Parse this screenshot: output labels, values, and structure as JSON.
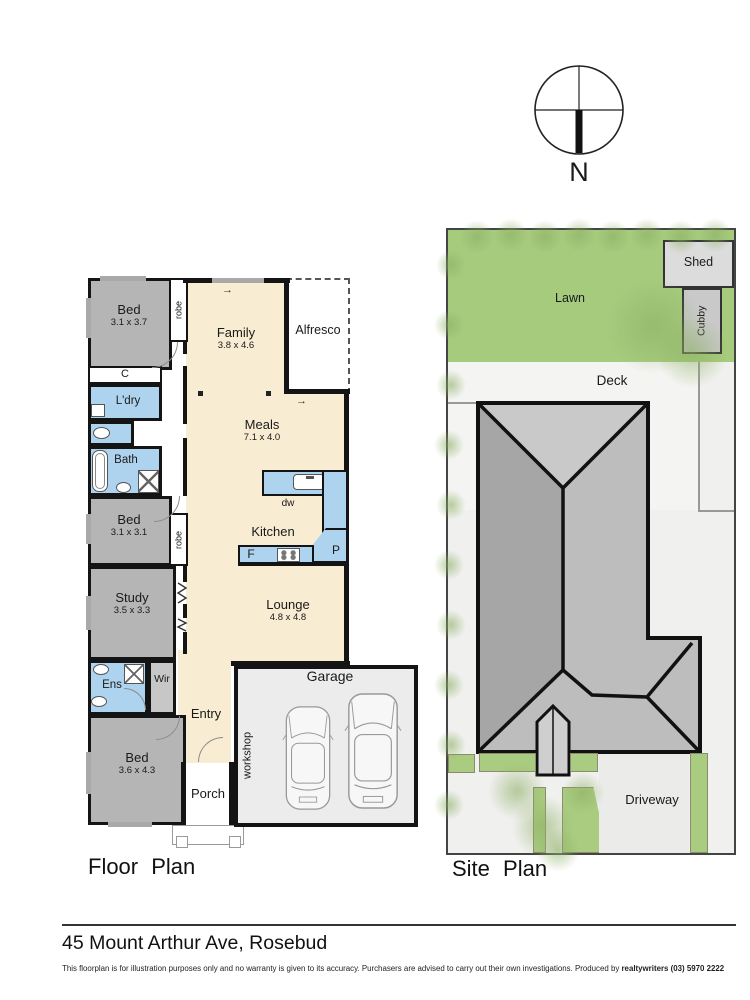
{
  "compass": {
    "north_label": "N"
  },
  "icons": {
    "arrow_right": "→"
  },
  "floor_plan": {
    "title": "Floor Plan",
    "rooms": {
      "bed1": {
        "label": "Bed",
        "dims": "3.1 x 3.7"
      },
      "robe1": {
        "label": "robe"
      },
      "closet": {
        "label": "C"
      },
      "laundry": {
        "label": "L'dry"
      },
      "bath": {
        "label": "Bath"
      },
      "bed2": {
        "label": "Bed",
        "dims": "3.1 x 3.1"
      },
      "robe2": {
        "label": "robe"
      },
      "study": {
        "label": "Study",
        "dims": "3.5 x 3.3"
      },
      "ensuite": {
        "label": "Ens"
      },
      "wir": {
        "label": "Wir"
      },
      "bed3": {
        "label": "Bed",
        "dims": "3.6 x 4.3"
      },
      "entry": {
        "label": "Entry"
      },
      "porch": {
        "label": "Porch"
      },
      "family": {
        "label": "Family",
        "dims": "3.8 x 4.6"
      },
      "alfresco": {
        "label": "Alfresco"
      },
      "meals": {
        "label": "Meals",
        "dims": "7.1 x 4.0"
      },
      "kitchen": {
        "label": "Kitchen"
      },
      "dishwasher": {
        "label": "dw"
      },
      "fridge": {
        "label": "F"
      },
      "pantry": {
        "label": "P"
      },
      "lounge": {
        "label": "Lounge",
        "dims": "4.8 x 4.8"
      },
      "garage": {
        "label": "Garage"
      },
      "workshop": {
        "label": "workshop"
      }
    }
  },
  "site_plan": {
    "title": "Site Plan",
    "labels": {
      "lawn": "Lawn",
      "shed": "Shed",
      "cubby": "Cubby",
      "deck": "Deck",
      "driveway": "Driveway"
    }
  },
  "footer": {
    "address": "45 Mount Arthur Ave, Rosebud",
    "disclaimer": "This floorplan is for illustration purposes only and no warranty is given to its accuracy. Purchasers are advised to carry out their own investigations. Produced by ",
    "producer": "realtywriters (03) 5970 2222"
  },
  "colors": {
    "wall": "#141414",
    "room_gray": "#b5b5b5",
    "floor_cream": "#f8ecd2",
    "wet_area_blue": "#aed3ee",
    "garage_gray": "#ececec",
    "lawn_green": "#a6cb7d",
    "garden_green": "#a9cc80",
    "roof_light": "#c9c9c9",
    "roof_mid": "#bdbdbd",
    "roof_dark": "#a6a6a6",
    "site_background": "#f0f0ee"
  }
}
